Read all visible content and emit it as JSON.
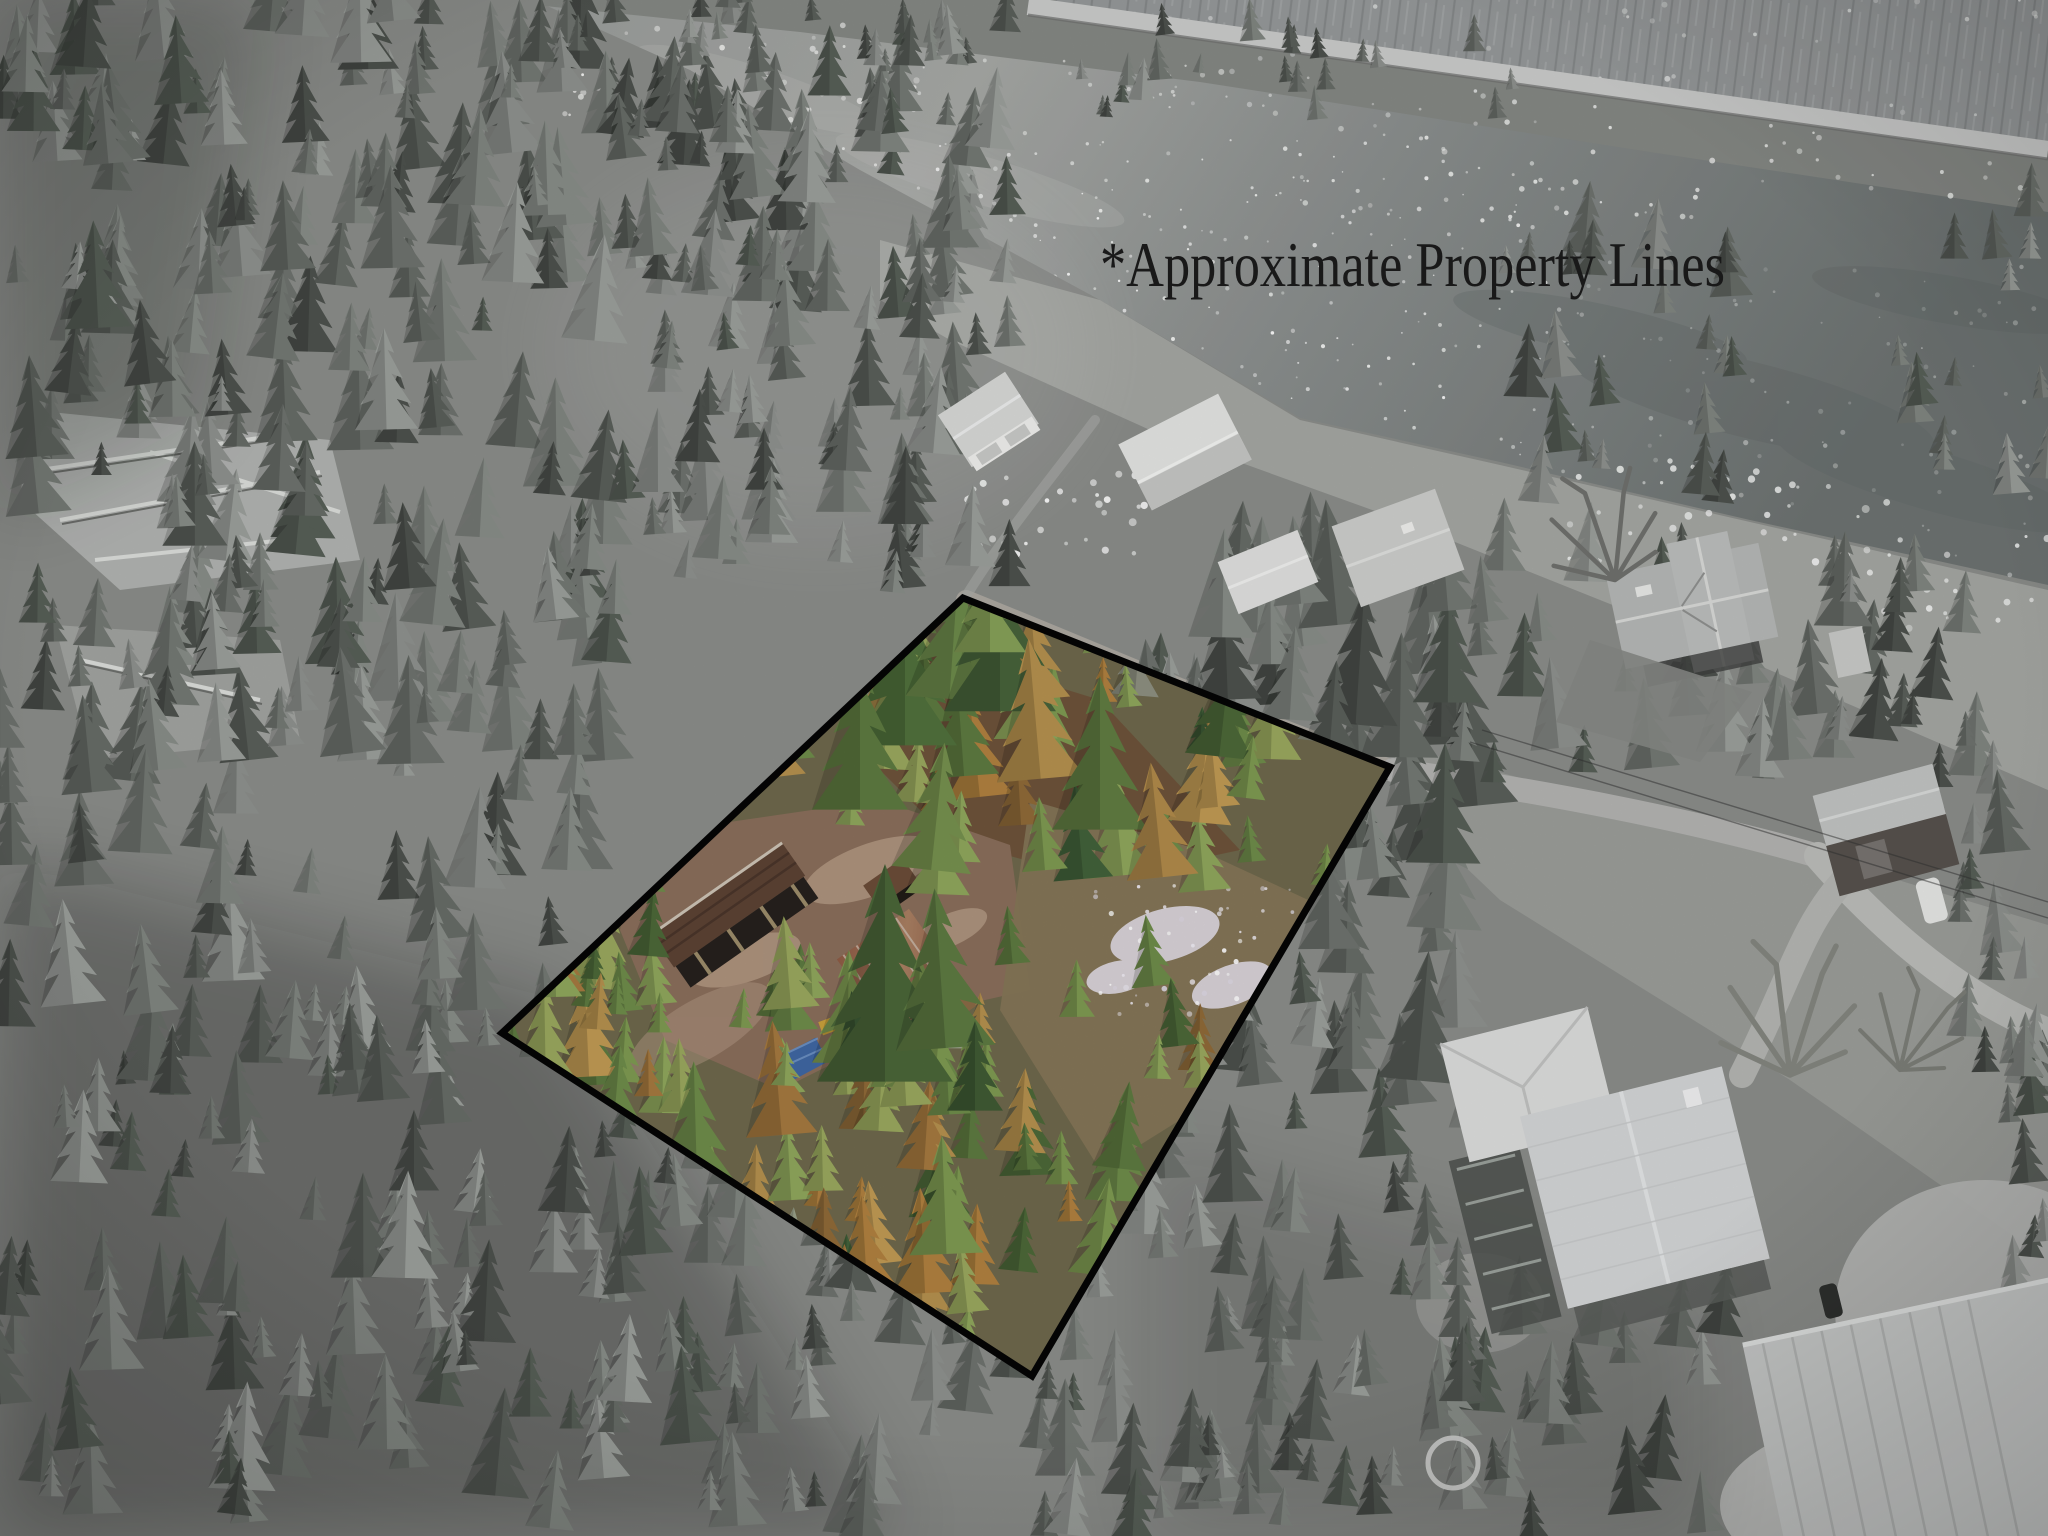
{
  "annotation": {
    "text": "*Approximate Property Lines",
    "color": "#1b1b1b"
  },
  "property_boundary": {
    "points": [
      [
        963,
        598
      ],
      [
        1390,
        767
      ],
      [
        1032,
        1376
      ],
      [
        502,
        1033
      ]
    ],
    "stroke_color": "#050505",
    "stroke_width": 7,
    "interior": "full color",
    "exterior": "desaturated grayscale"
  },
  "scene": {
    "kind": "aerial-drone-photo",
    "features": [
      "river",
      "riverside road",
      "rock cliff",
      "evergreen forest",
      "fallen logs",
      "riverfront houses",
      "dirt road",
      "property clearing",
      "garage",
      "rustic cabin",
      "lean-to shed",
      "blue tarp",
      "snow patches",
      "metal-roof house",
      "deck",
      "outbuilding",
      "fire-pit ring"
    ]
  },
  "palette": {
    "water": "#8d908f",
    "forest_gray": "#6f746f",
    "lawn_gray": "#a5a7a3",
    "road_gray": "#c9cac8",
    "dirt_brown": "#8a6e5b",
    "tree_green": "#5d7a40",
    "tree_gold": "#b5914e",
    "roof_rust": "#96604a",
    "tarp_blue": "#3f67a3",
    "roof_metal": "#d5d6d7",
    "boundary_black": "#050505",
    "text_black": "#1b1b1b"
  }
}
